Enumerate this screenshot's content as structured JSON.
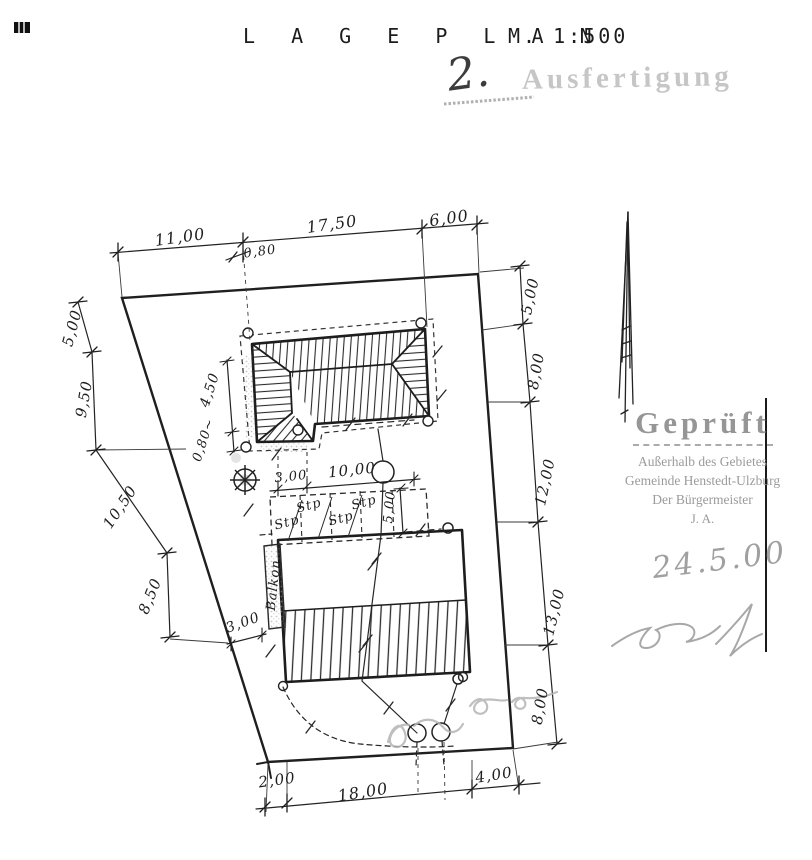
{
  "page": {
    "title": "L A G E P L A N",
    "scale": "M. 1:500"
  },
  "stamps": {
    "copy_number": "2.",
    "copy_stamp": "Ausfertigung",
    "approval": {
      "line1": "Geprüft",
      "line2": "Außerhalb des Gebietes",
      "line3": "Gemeinde Henstedt-Ulzburg",
      "line4": "Der Bürgermeister",
      "line5": "J. A.",
      "date": "24.5.00"
    }
  },
  "plan": {
    "ink_color": "#222222",
    "stamp_color": "#9b9b9b",
    "pencil_color": "#b4b4b4",
    "labels": [
      {
        "t": "11,00",
        "x": 180,
        "y": 237,
        "r": -8,
        "s": 16
      },
      {
        "t": "17,50",
        "x": 332,
        "y": 224,
        "r": -8,
        "s": 16
      },
      {
        "t": "6,00",
        "x": 449,
        "y": 218,
        "r": -8,
        "s": 16
      },
      {
        "t": "0,80",
        "x": 260,
        "y": 252,
        "r": -8,
        "s": 13
      },
      {
        "t": "5,00",
        "x": 72,
        "y": 328,
        "r": -75,
        "s": 15
      },
      {
        "t": "9,50",
        "x": 84,
        "y": 399,
        "r": -80,
        "s": 15
      },
      {
        "t": "10,50",
        "x": 120,
        "y": 507,
        "r": -56,
        "s": 15
      },
      {
        "t": "8,50",
        "x": 150,
        "y": 596,
        "r": -68,
        "s": 15
      },
      {
        "t": "5,00",
        "x": 530,
        "y": 296,
        "r": -78,
        "s": 15
      },
      {
        "t": "8,00",
        "x": 536,
        "y": 371,
        "r": -80,
        "s": 15
      },
      {
        "t": "12,00",
        "x": 545,
        "y": 482,
        "r": -78,
        "s": 15
      },
      {
        "t": "13,00",
        "x": 554,
        "y": 612,
        "r": -76,
        "s": 15
      },
      {
        "t": "8,00",
        "x": 540,
        "y": 706,
        "r": -80,
        "s": 15
      },
      {
        "t": "2,00",
        "x": 277,
        "y": 780,
        "r": -8,
        "s": 15
      },
      {
        "t": "18,00",
        "x": 363,
        "y": 792,
        "r": -9,
        "s": 16
      },
      {
        "t": "4,00",
        "x": 494,
        "y": 775,
        "r": -9,
        "s": 15
      },
      {
        "t": "3,00",
        "x": 291,
        "y": 477,
        "r": -6,
        "s": 13
      },
      {
        "t": "10,00",
        "x": 352,
        "y": 470,
        "r": -6,
        "s": 15
      },
      {
        "t": "5,00",
        "x": 390,
        "y": 507,
        "r": -85,
        "s": 13
      },
      {
        "t": "4,50",
        "x": 210,
        "y": 390,
        "r": -72,
        "s": 14
      },
      {
        "t": "0,80~",
        "x": 204,
        "y": 440,
        "r": -72,
        "s": 13
      },
      {
        "t": "3,00",
        "x": 243,
        "y": 623,
        "r": -20,
        "s": 14
      },
      {
        "t": "Stp",
        "x": 287,
        "y": 523,
        "r": -15,
        "s": 13,
        "n": "parking-stall-label"
      },
      {
        "t": "Stp",
        "x": 309,
        "y": 506,
        "r": -15,
        "s": 13,
        "n": "parking-stall-label"
      },
      {
        "t": "Stp",
        "x": 341,
        "y": 519,
        "r": -15,
        "s": 13,
        "n": "parking-stall-label"
      },
      {
        "t": "Stp",
        "x": 364,
        "y": 503,
        "r": -15,
        "s": 13,
        "n": "parking-stall-label"
      },
      {
        "t": "Balkon",
        "x": 274,
        "y": 585,
        "r": -84,
        "s": 13,
        "n": "balkon-label"
      }
    ]
  }
}
